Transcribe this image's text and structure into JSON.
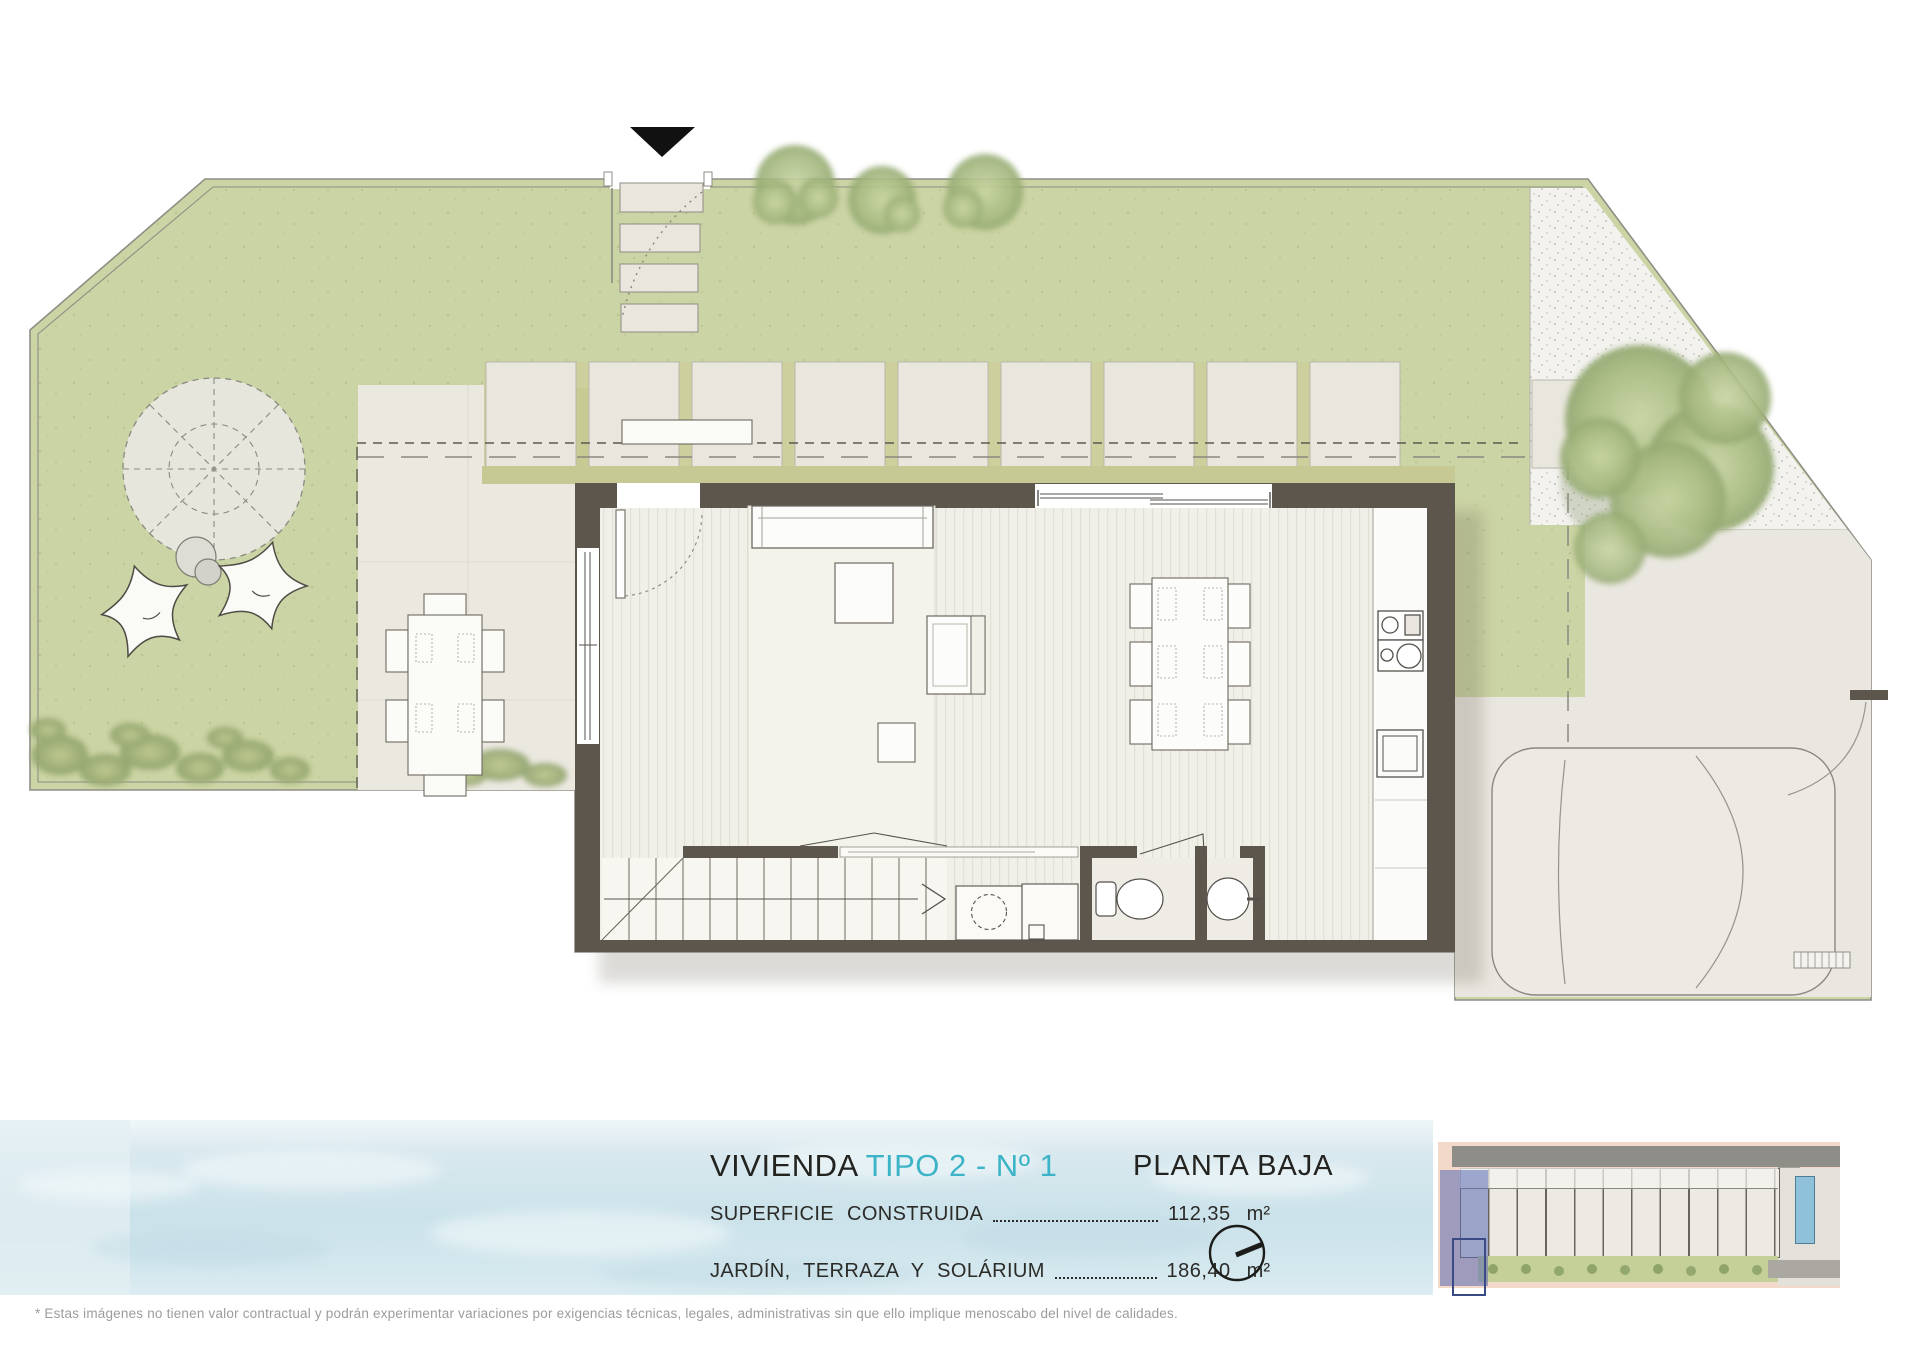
{
  "title": {
    "prefix": "VIVIENDA",
    "accent": "TIPO 2 - Nº 1"
  },
  "plan_label": "PLANTA BAJA",
  "areas": {
    "row1": {
      "label": "SUPERFICIE   CONSTRUIDA",
      "value": "112,35",
      "unit": "m²"
    },
    "row2": {
      "label": "JARDÍN,  TERRAZA  Y  SOLÁRIUM",
      "value": "186,40",
      "unit": "m²"
    }
  },
  "disclaimer": "* Estas imágenes no tienen valor contractual y podrán experimentar variaciones por exigencias técnicas, legales, administrativas sin que ello implique menoscabo del nivel de calidades.",
  "icons": {
    "compass": "north-compass-icon",
    "north_arrow": "north-triangle-icon"
  },
  "colors": {
    "accent_cyan": "#3cb4c7",
    "lawn_green": "#cbd4a4",
    "hedge_olive": "#c8ca94",
    "wall_brown": "#5d564c",
    "terrace_beige": "#ebe8e0",
    "gravel": "#f3f2ee",
    "water_blue": "#cbe2ea",
    "highlight_unit_blue": "#5868b2",
    "text_black": "#232320",
    "disclaimer_grey": "#9c9c9c"
  }
}
